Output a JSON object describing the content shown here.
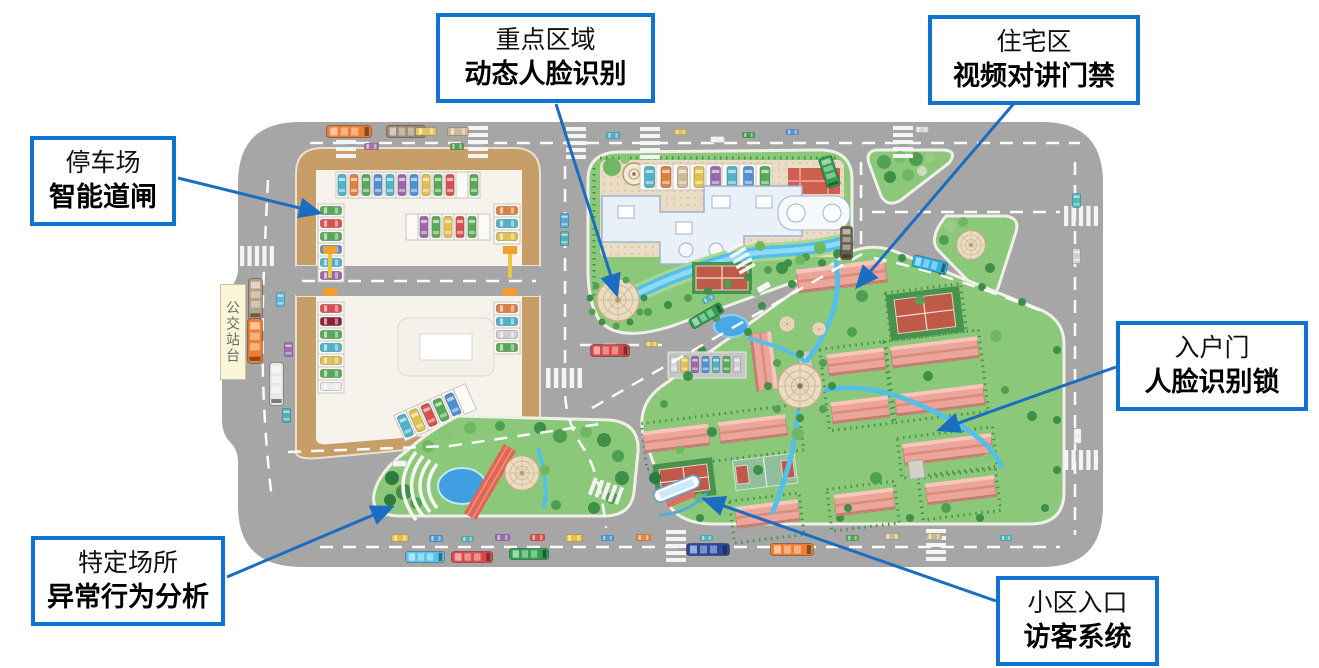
{
  "callouts": [
    {
      "id": "parking",
      "line1": "停车场",
      "line2": "智能道闸"
    },
    {
      "id": "key-area",
      "line1": "重点区域",
      "line2": "动态人脸识别"
    },
    {
      "id": "residential",
      "line1": "住宅区",
      "line2": "视频对讲门禁"
    },
    {
      "id": "entry-door",
      "line1": "入户门",
      "line2": "人脸识别锁"
    },
    {
      "id": "specific-place",
      "line1": "特定场所",
      "line2": "异常行为分析"
    },
    {
      "id": "community-entrance",
      "line1": "小区入口",
      "line2": "访客系统"
    }
  ],
  "map": {
    "bus_stop_label": "公交站台"
  },
  "colors": {
    "callout_border": "#0e74cf",
    "arrow": "#1b6dc1",
    "road": "#a6a6a6",
    "parking_tan": "#c79e68",
    "lawn": "#8cc87a",
    "water": "#54bfe8",
    "plaza_tan": "#eadbc3",
    "building_pink": "#eca699",
    "building_blue": "#e9f0f8",
    "court_red": "#c05a48"
  }
}
